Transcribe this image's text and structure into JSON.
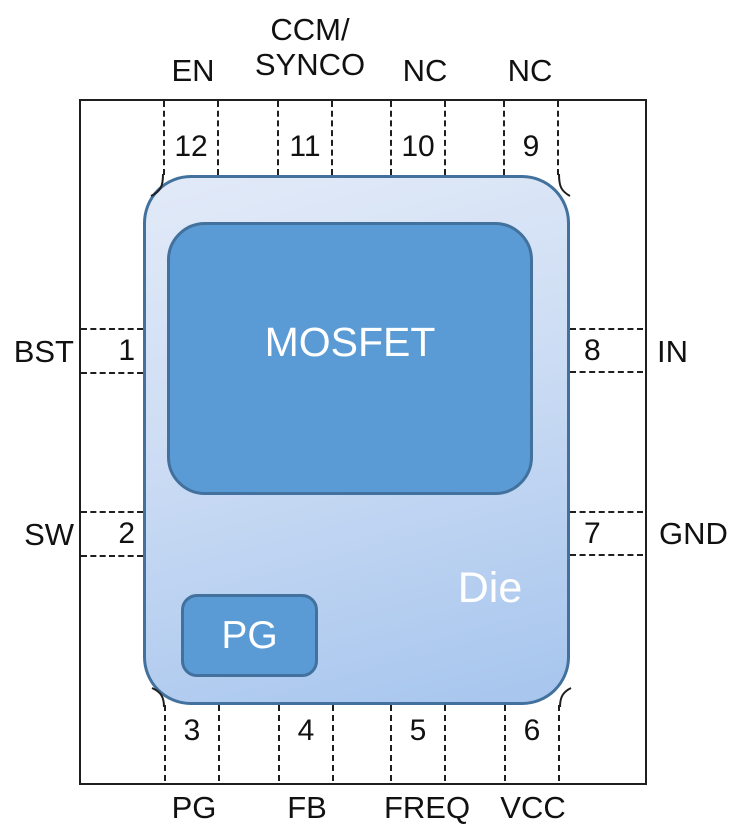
{
  "diagram": {
    "die_label": "Die",
    "mosfet_label": "MOSFET",
    "pg_block_label": "PG"
  },
  "pins": {
    "top": [
      {
        "num": "12",
        "label": "EN"
      },
      {
        "num": "11",
        "label": "CCM/\nSYNCO"
      },
      {
        "num": "10",
        "label": "NC"
      },
      {
        "num": "9",
        "label": "NC"
      }
    ],
    "bottom": [
      {
        "num": "3",
        "label": "PG"
      },
      {
        "num": "4",
        "label": "FB"
      },
      {
        "num": "5",
        "label": "FREQ"
      },
      {
        "num": "6",
        "label": "VCC"
      }
    ],
    "left": [
      {
        "num": "1",
        "label": "BST"
      },
      {
        "num": "2",
        "label": "SW"
      }
    ],
    "right": [
      {
        "num": "8",
        "label": "IN"
      },
      {
        "num": "7",
        "label": "GND"
      }
    ]
  },
  "colors": {
    "fill_block": "#5b9bd5",
    "stroke_block": "#41719c",
    "die_gradient_top": "#e2eaf8",
    "die_gradient_bottom": "#a6c5ee",
    "outline": "#1f1f1f"
  }
}
